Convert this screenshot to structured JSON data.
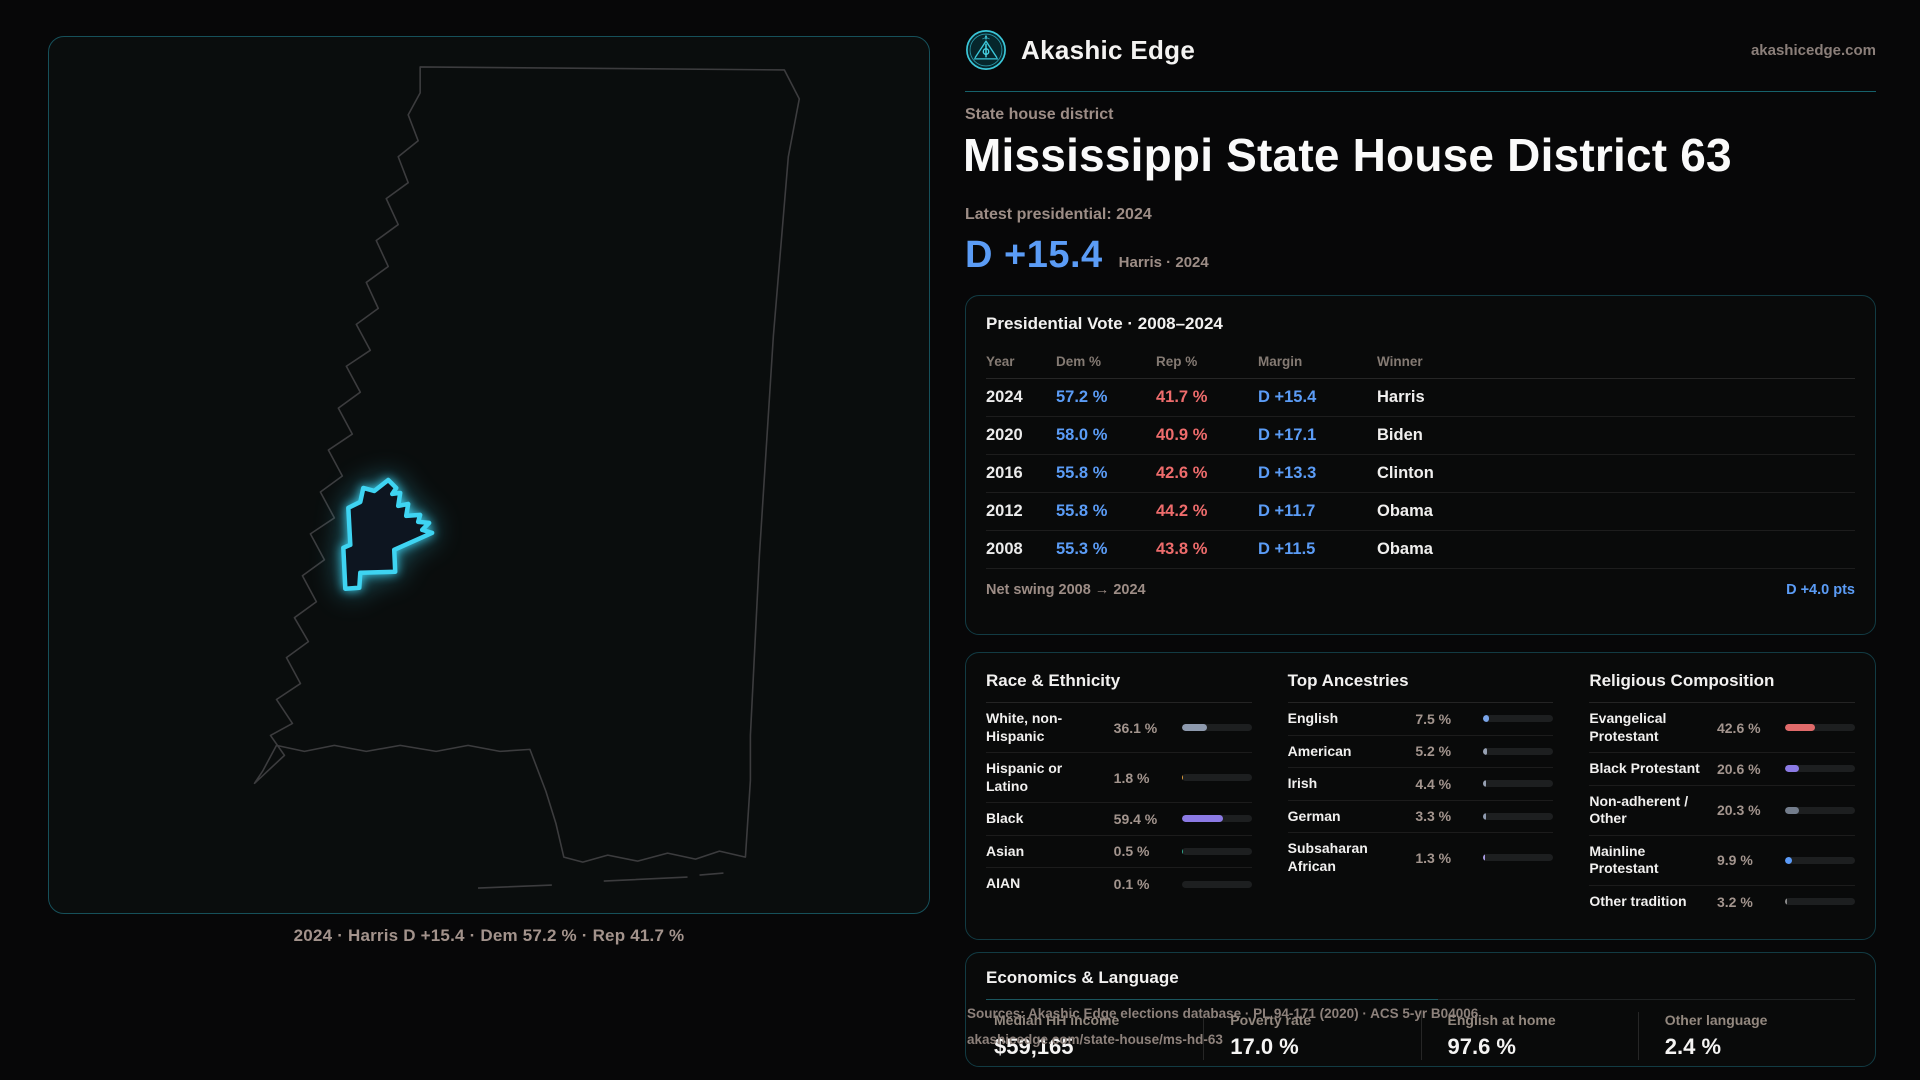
{
  "brand": {
    "name": "Akashic Edge",
    "domain": "akashicedge.com"
  },
  "page": {
    "eyebrow": "State house district",
    "title": "Mississippi State House District 63",
    "latest_label": "Latest presidential: 2024",
    "headline_margin": "D +15.4",
    "headline_context": "Harris · 2024"
  },
  "map": {
    "caption": "2024 · Harris D +15.4 · Dem 57.2 % · Rep 41.7 %"
  },
  "presidential": {
    "title": "Presidential Vote · 2008–2024",
    "columns": [
      "Year",
      "Dem %",
      "Rep %",
      "Margin",
      "Winner"
    ],
    "rows": [
      {
        "year": "2024",
        "dem": "57.2 %",
        "rep": "41.7 %",
        "margin": "D +15.4",
        "winner": "Harris"
      },
      {
        "year": "2020",
        "dem": "58.0 %",
        "rep": "40.9 %",
        "margin": "D +17.1",
        "winner": "Biden"
      },
      {
        "year": "2016",
        "dem": "55.8 %",
        "rep": "42.6 %",
        "margin": "D +13.3",
        "winner": "Clinton"
      },
      {
        "year": "2012",
        "dem": "55.8 %",
        "rep": "44.2 %",
        "margin": "D +11.7",
        "winner": "Obama"
      },
      {
        "year": "2008",
        "dem": "55.3 %",
        "rep": "43.8 %",
        "margin": "D +11.5",
        "winner": "Obama"
      }
    ],
    "net_swing_label": "Net swing 2008 → 2024",
    "net_swing_value": "D +4.0 pts"
  },
  "chart_data": [
    {
      "type": "bar",
      "title": "Race & Ethnicity",
      "categories": [
        "White, non-Hispanic",
        "Hispanic or Latino",
        "Black",
        "Asian",
        "AIAN"
      ],
      "values": [
        36.1,
        1.8,
        59.4,
        0.5,
        0.1
      ],
      "ylim": [
        0,
        100
      ]
    },
    {
      "type": "bar",
      "title": "Top Ancestries",
      "categories": [
        "English",
        "American",
        "Irish",
        "German",
        "Subsaharan African"
      ],
      "values": [
        7.5,
        5.2,
        4.4,
        3.3,
        1.3
      ],
      "ylim": [
        0,
        100
      ]
    },
    {
      "type": "bar",
      "title": "Religious Composition",
      "categories": [
        "Evangelical Protestant",
        "Black Protestant",
        "Non-adherent / Other",
        "Mainline Protestant",
        "Other tradition"
      ],
      "values": [
        42.6,
        20.6,
        20.3,
        9.9,
        3.2
      ],
      "ylim": [
        0,
        100
      ]
    }
  ],
  "demographics": {
    "race": {
      "title": "Race & Ethnicity",
      "items": [
        {
          "label": "White, non-Hispanic",
          "value": "36.1 %",
          "pct": 36.1,
          "color": "#8d99ad"
        },
        {
          "label": "Hispanic or Latino",
          "value": "1.8 %",
          "pct": 1.8,
          "color": "#df9e3c"
        },
        {
          "label": "Black",
          "value": "59.4 %",
          "pct": 59.4,
          "color": "#8b7ae4"
        },
        {
          "label": "Asian",
          "value": "0.5 %",
          "pct": 0.5,
          "color": "#2fa98d"
        },
        {
          "label": "AIAN",
          "value": "0.1 %",
          "pct": 0.1,
          "color": "#7d828a"
        }
      ]
    },
    "ancestries": {
      "title": "Top Ancestries",
      "items": [
        {
          "label": "English",
          "value": "7.5 %",
          "pct": 7.5,
          "color": "#7aa5e9"
        },
        {
          "label": "American",
          "value": "5.2 %",
          "pct": 5.2,
          "color": "#97a1b3"
        },
        {
          "label": "Irish",
          "value": "4.4 %",
          "pct": 4.4,
          "color": "#97a1b3"
        },
        {
          "label": "German",
          "value": "3.3 %",
          "pct": 3.3,
          "color": "#8f9bb0"
        },
        {
          "label": "Subsaharan African",
          "value": "1.3 %",
          "pct": 1.3,
          "color": "#a79ae0"
        }
      ]
    },
    "religion": {
      "title": "Religious Composition",
      "items": [
        {
          "label": "Evangelical Protestant",
          "value": "42.6 %",
          "pct": 42.6,
          "color": "#e06a6a"
        },
        {
          "label": "Black Protestant",
          "value": "20.6 %",
          "pct": 20.6,
          "color": "#8b7ae4"
        },
        {
          "label": "Non-adherent / Other",
          "value": "20.3 %",
          "pct": 20.3,
          "color": "#737d8c"
        },
        {
          "label": "Mainline Protestant",
          "value": "9.9 %",
          "pct": 9.9,
          "color": "#5b9bf8"
        },
        {
          "label": "Other tradition",
          "value": "3.2 %",
          "pct": 3.2,
          "color": "#8a8a8a"
        }
      ]
    }
  },
  "economics": {
    "title": "Economics & Language",
    "stats": [
      {
        "label": "Median HH income",
        "value": "$59,165"
      },
      {
        "label": "Poverty rate",
        "value": "17.0 %"
      },
      {
        "label": "English at home",
        "value": "97.6 %"
      },
      {
        "label": "Other language",
        "value": "2.4 %"
      }
    ]
  },
  "sources": {
    "line1": "Sources: Akashic Edge elections database · PL 94-171 (2020) · ACS 5-yr B04006",
    "line2": "akashicedge.com/state-house/ms-hd-63"
  },
  "colors": {
    "dem_blue": "#5b9cf6",
    "rep_red": "#ee6c6c",
    "district_cyan": "#3ed4f2",
    "accent_teal": "#16616b",
    "muted_text": "#9d8d86"
  }
}
